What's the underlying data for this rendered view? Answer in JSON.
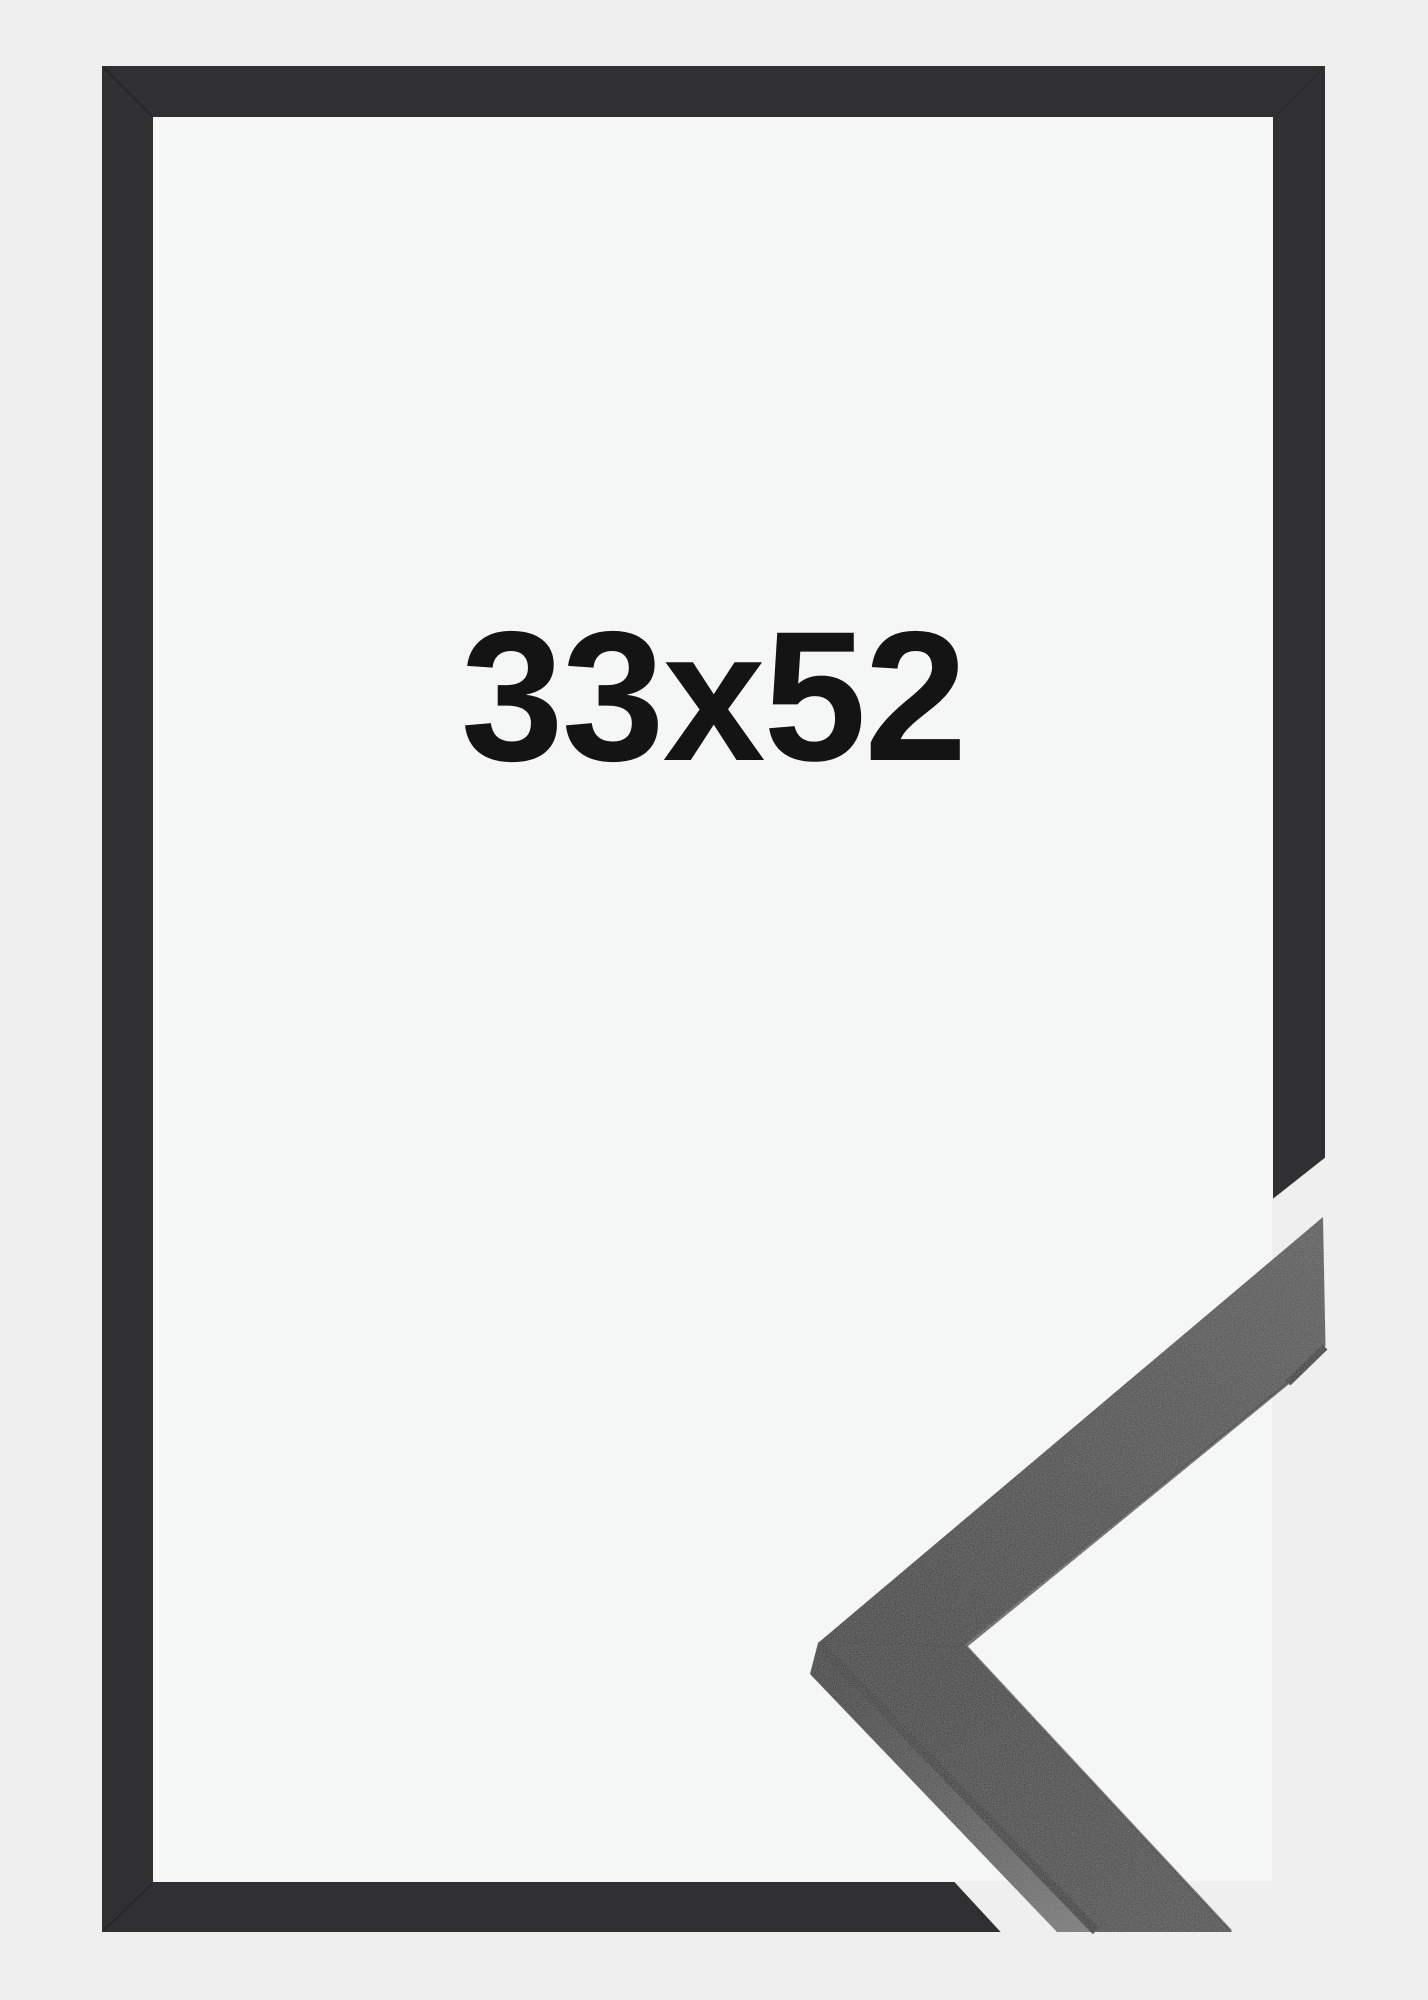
{
  "product": {
    "size_label": "33x52",
    "colors": {
      "background": "#efefef",
      "frame": "#303032",
      "opening": "#f5f6f6",
      "label": "#141414"
    }
  }
}
